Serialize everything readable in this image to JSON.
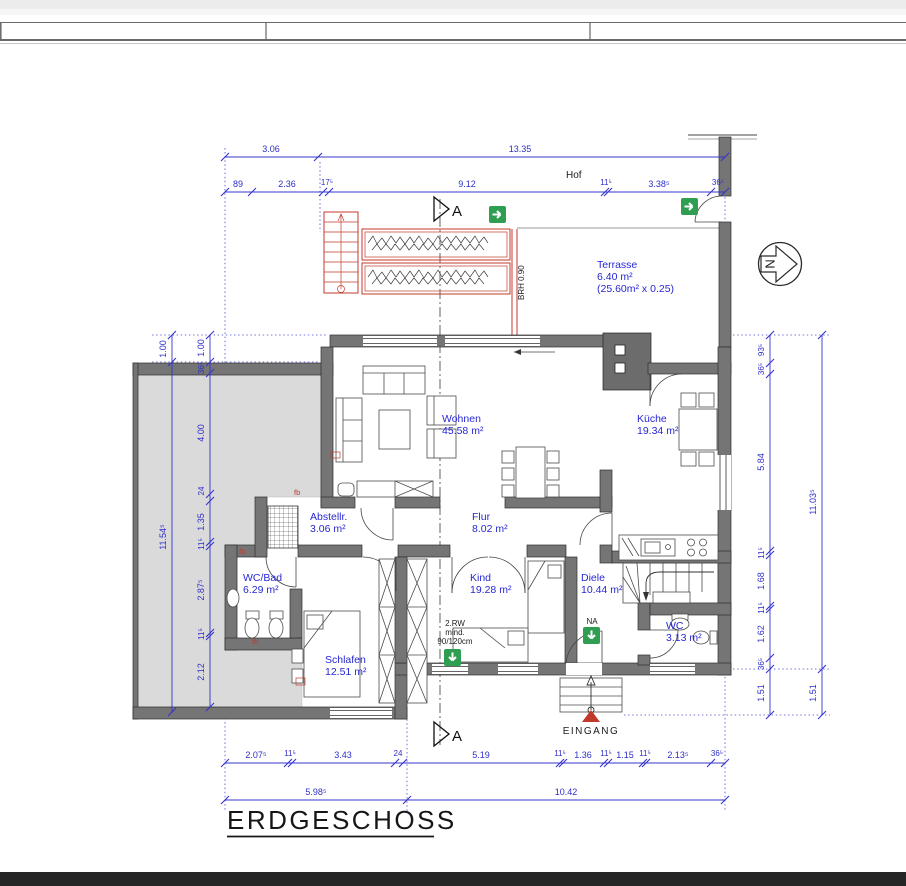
{
  "title": "ERDGESCHOSS",
  "header": {
    "hof": "Hof"
  },
  "rooms": {
    "terrasse": {
      "name": "Terrasse",
      "area": "6.40 m²",
      "note": "(25.60m² x 0.25)"
    },
    "wohnen": {
      "name": "Wohnen",
      "area": "45.58 m²"
    },
    "kueche": {
      "name": "Küche",
      "area": "19.34 m²"
    },
    "abstellraum": {
      "name": "Abstellr.",
      "area": "3.06 m²"
    },
    "flur": {
      "name": "Flur",
      "area": "8.02 m²"
    },
    "wc_bad": {
      "name": "WC/Bad",
      "area": "6.29 m²"
    },
    "kind": {
      "name": "Kind",
      "area": "19.28 m²"
    },
    "diele": {
      "name": "Diele",
      "area": "10.44 m²"
    },
    "schlafen": {
      "name": "Schlafen",
      "area": "12.51 m²"
    },
    "wc": {
      "name": "WC",
      "area": "3.13 m²"
    }
  },
  "annotations": {
    "brh": "BRH 0.90",
    "eingang": "EINGANG",
    "na": "NA",
    "rw1": "2.RW",
    "rw2": "mind.",
    "rw3": "90/120cm",
    "north": "N",
    "section": "A",
    "fb": "fb"
  },
  "dims": {
    "top1": [
      "3.06",
      "13.35"
    ],
    "top2": [
      "89",
      "2.36",
      "17⁵",
      "9.12",
      "11⁵",
      "3.38⁵",
      "36⁵"
    ],
    "left_outer": [
      "1.00",
      "11.54⁵"
    ],
    "left_inner": [
      "1.00",
      "36⁵",
      "4.00",
      "24",
      "1.35",
      "11⁵",
      "2.87⁵",
      "11⁵",
      "2.12"
    ],
    "right_inner": [
      "93⁵",
      "36⁵",
      "5.84",
      "11⁵",
      "1.68",
      "11⁵",
      "1.62",
      "36⁵",
      "1.51"
    ],
    "right_outer": [
      "11.03⁵",
      "1.51"
    ],
    "bottom1": [
      "2.07⁵",
      "11⁵",
      "3.43",
      "24",
      "5.19",
      "11⁵",
      "1.36",
      "11⁵",
      "1.15",
      "11⁵",
      "2.13⁵",
      "36⁵"
    ],
    "bottom2": [
      "5.98⁵",
      "10.42"
    ]
  },
  "colors": {
    "dimension": "#3434cd",
    "wall": "#757575",
    "annex_fill": "#dadada",
    "red": "#c4392b",
    "green": "#2f9e52"
  }
}
